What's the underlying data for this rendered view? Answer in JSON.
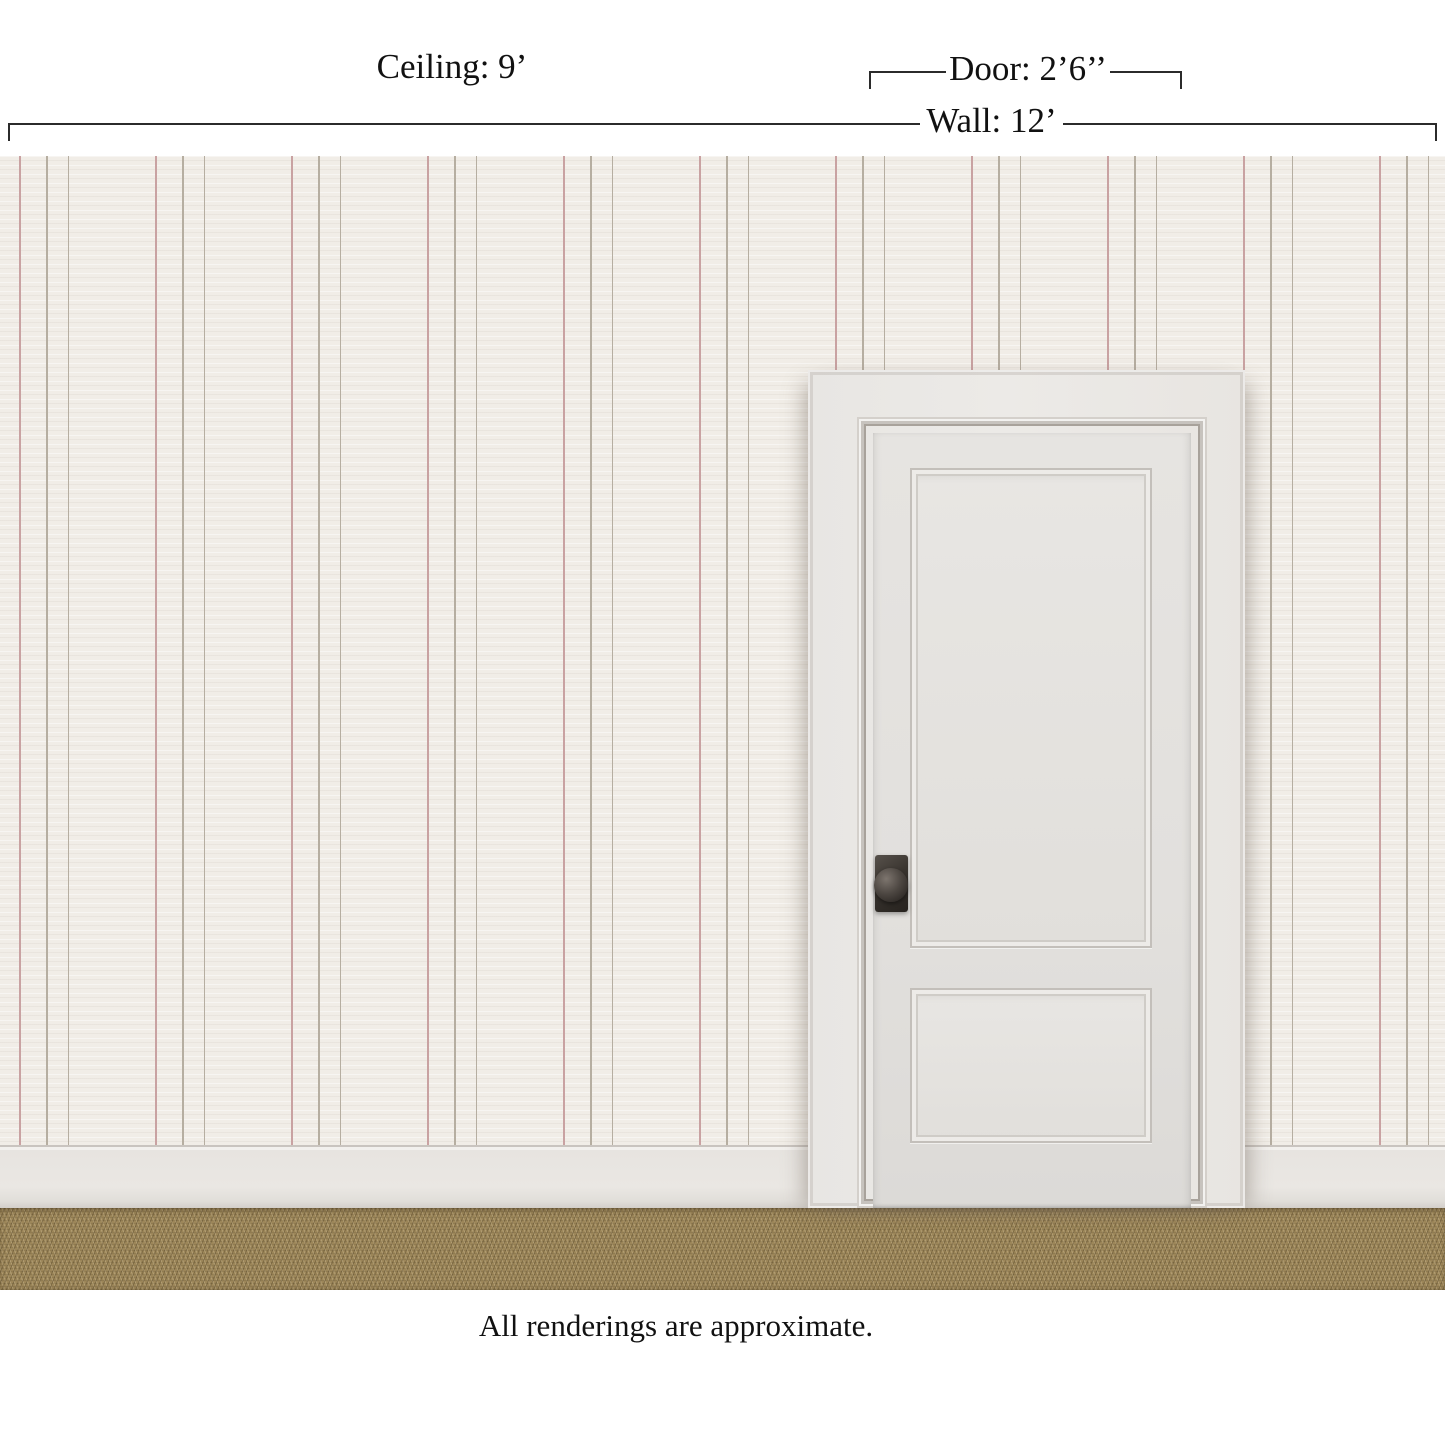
{
  "annotations": {
    "ceiling": {
      "label": "Ceiling: 9’"
    },
    "door": {
      "label": "Door: 2’6’’"
    },
    "wall": {
      "label": "Wall: 12’"
    }
  },
  "caption": "All renderings are approximate.",
  "colors": {
    "line": "#2b2b2b",
    "text": "#111111",
    "wall_bg": "#f1ede7",
    "stripe_pink": "#c9a2a2",
    "stripe_gray": "#b6aea1",
    "baseboard": "#eae7e3",
    "carpet": "#9c8659",
    "door_face": "#eceae7",
    "door_slab": "#e2e0dd",
    "knob": "#39342f"
  }
}
